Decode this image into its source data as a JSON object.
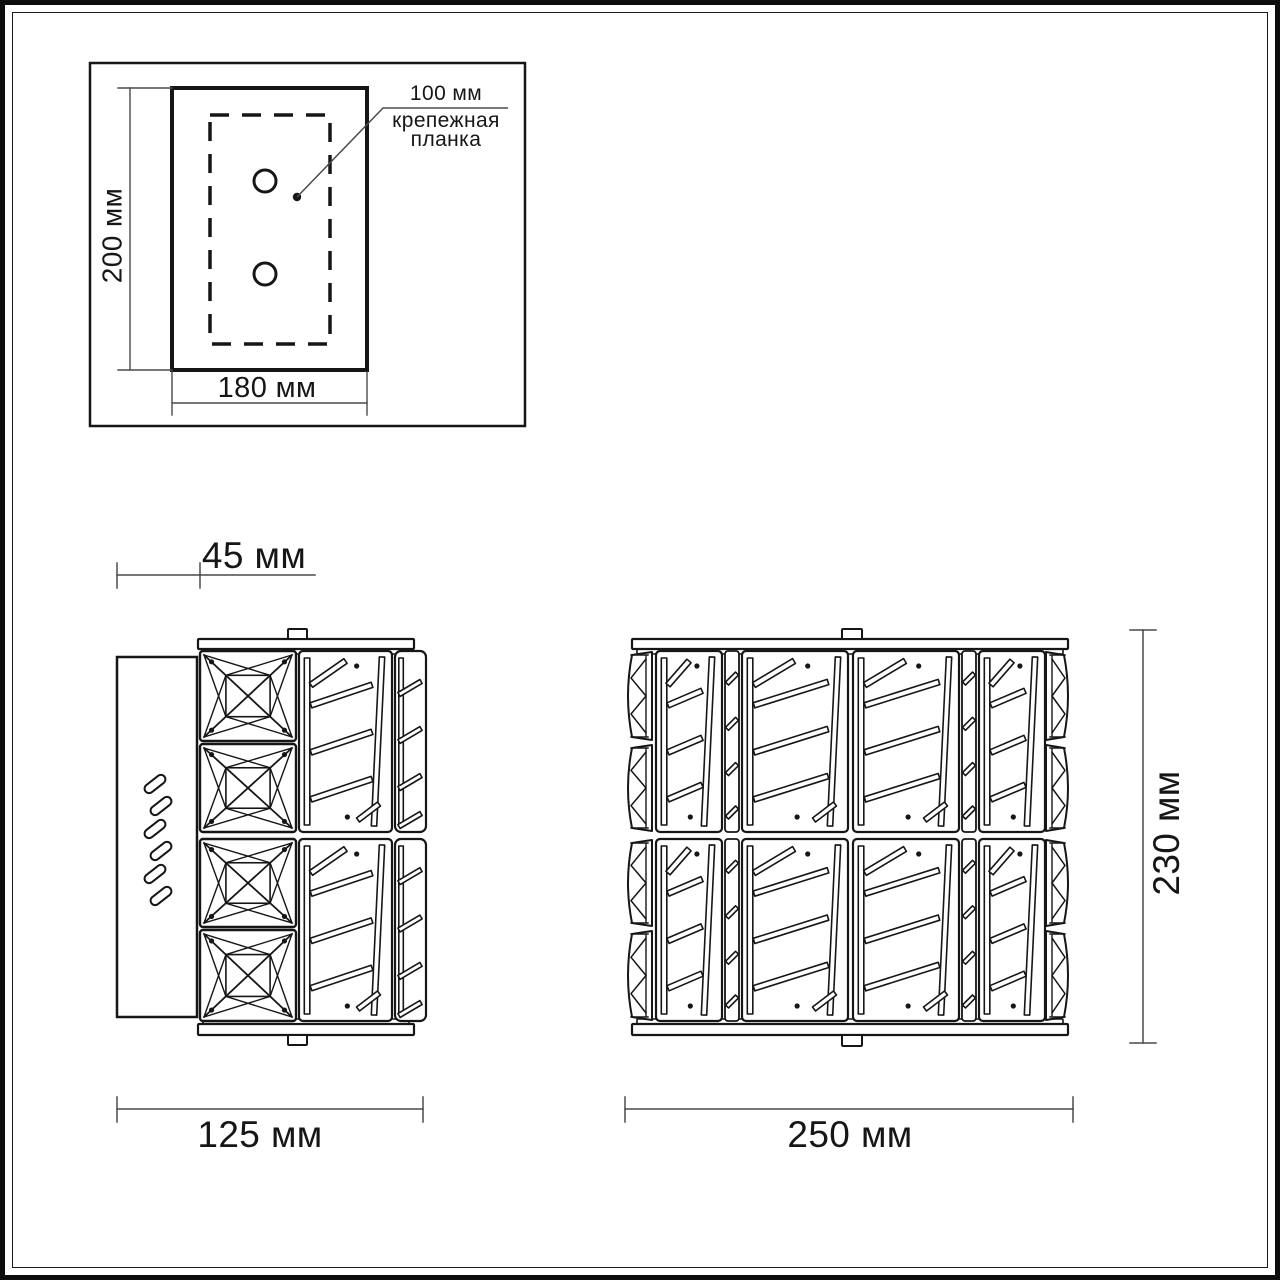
{
  "colors": {
    "line": "#161616",
    "dimension": "#4a4a4a",
    "background": "#ffffff"
  },
  "mounting_plate": {
    "height_label": "200 мм",
    "width_label": "180 мм",
    "callout_value": "100 мм",
    "callout_name_line1": "крепежная",
    "callout_name_line2": "планка"
  },
  "side_view": {
    "depth_label": "45 мм",
    "width_label": "125 мм"
  },
  "front_view": {
    "width_label": "250 мм",
    "height_label": "230 мм"
  }
}
